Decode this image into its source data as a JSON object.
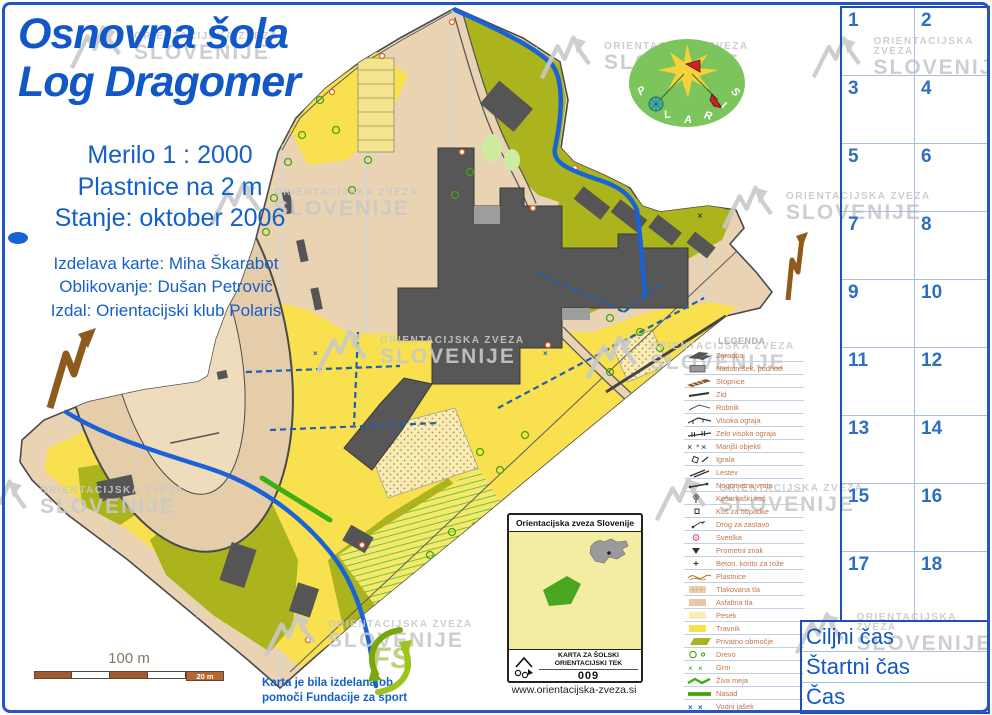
{
  "title": {
    "line1": "Osnovna šola",
    "line2": "Log Dragomer"
  },
  "map_info": {
    "scale": "Merilo 1 : 2000",
    "contour_interval": "Plastnice na 2 m",
    "status": "Stanje: oktober 2006"
  },
  "credits": {
    "cartography": "Izdelava karte: Miha Škarabot",
    "design": "Oblikovanje: Dušan Petrovič",
    "publisher": "Izdal: Orientacijski klub Polaris"
  },
  "watermark": {
    "line1": "ORIENTACIJSKA ZVEZA",
    "line2": "SLOVENIJE"
  },
  "polaris_logo": {
    "letters": [
      "P",
      "L",
      "A",
      "R",
      "I",
      "S"
    ]
  },
  "legend": {
    "header": "LEGENDA",
    "items": [
      {
        "label": "Zgradba",
        "symbol": "building"
      },
      {
        "label": "Nadstrešek, podhod",
        "symbol": "canopy"
      },
      {
        "label": "Stopnice",
        "symbol": "stairs"
      },
      {
        "label": "Zid",
        "symbol": "wall"
      },
      {
        "label": "Robnik",
        "symbol": "curb"
      },
      {
        "label": "Visoka ograja",
        "symbol": "high-fence"
      },
      {
        "label": "Zelo visoka ograja",
        "symbol": "very-high-fence"
      },
      {
        "label": "Manjši objekti",
        "symbol": "small-objects"
      },
      {
        "label": "Igrala",
        "symbol": "playground"
      },
      {
        "label": "Lestev",
        "symbol": "ladder"
      },
      {
        "label": "Nogometna vrata",
        "symbol": "goal"
      },
      {
        "label": "Košarkaški koš",
        "symbol": "basketball"
      },
      {
        "label": "Koš za odpadke",
        "symbol": "bin"
      },
      {
        "label": "Drog za zastavo",
        "symbol": "flagpole"
      },
      {
        "label": "Svetilka",
        "symbol": "lamp"
      },
      {
        "label": "Prometni znak",
        "symbol": "traffic-sign"
      },
      {
        "label": "Beton. korito za rože",
        "symbol": "planter"
      },
      {
        "label": "Plastnice",
        "symbol": "contours"
      },
      {
        "label": "Tlakovana tla",
        "symbol": "paved"
      },
      {
        "label": "Asfaltna tla",
        "symbol": "asphalt"
      },
      {
        "label": "Pesek",
        "symbol": "sand"
      },
      {
        "label": "Travnik",
        "symbol": "grass"
      },
      {
        "label": "Privatno območje",
        "symbol": "private"
      },
      {
        "label": "Drevo",
        "symbol": "tree"
      },
      {
        "label": "Grm",
        "symbol": "bush"
      },
      {
        "label": "Živa meja",
        "symbol": "hedge"
      },
      {
        "label": "Nasad",
        "symbol": "plantation"
      },
      {
        "label": "Vodni jašek",
        "symbol": "water-shaft"
      },
      {
        "label": "Hidrant",
        "symbol": "hydrant"
      }
    ]
  },
  "control_card": {
    "cell_numbers": [
      "1",
      "2",
      "3",
      "4",
      "5",
      "6",
      "7",
      "8",
      "9",
      "10",
      "11",
      "12",
      "13",
      "14",
      "15",
      "16",
      "17",
      "18"
    ],
    "footer_rows": [
      "Ciljni čas",
      "Štartni čas",
      "Čas"
    ]
  },
  "inset_card": {
    "header": "Orientacijska zveza Slovenije",
    "type_line1": "KARTA ZA ŠOLSKI",
    "type_line2": "ORIENTACIJSKI TEK",
    "map_number": "009",
    "website": "www.orientacijska-zveza.si"
  },
  "scale_bar": {
    "total_label": "100 m",
    "segment_label": "20 m"
  },
  "funding_note": {
    "line1": "Karta je bila izdelana ob",
    "line2": "pomoči Fundacije za šport"
  },
  "colors": {
    "title_blue": "#1157c8",
    "border_blue": "#2455c0",
    "legend_text": "#c4764e",
    "map_yellow": "#f8e04e",
    "map_tan": "#e9d3b2",
    "map_olive": "#abb41c",
    "building_gray": "#575757",
    "stream_blue": "#1a62d8",
    "watermark_gray": "#c9c9c9"
  }
}
